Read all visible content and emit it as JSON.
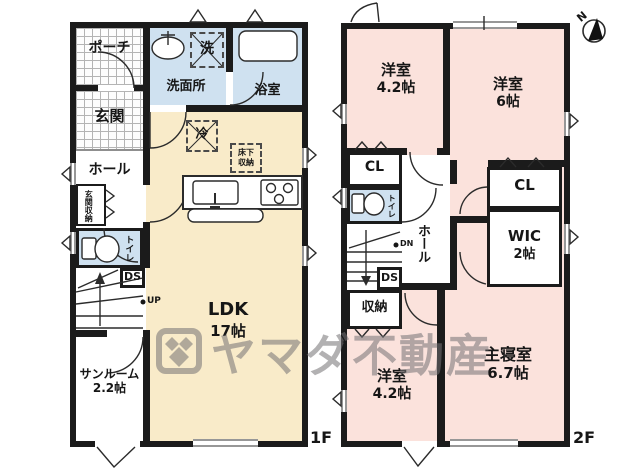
{
  "watermark": {
    "brand": "ヤマダ不動産"
  },
  "compass": {
    "north": "N"
  },
  "f1": {
    "floor_label": "1F",
    "porch": "ポーチ",
    "entrance": "玄関",
    "hall": "ホール",
    "entrance_storage": "玄関収納",
    "toilet": "トイレ",
    "ds": "DS",
    "up": "UP",
    "washroom": "洗面所",
    "washer": "洗",
    "bathroom": "浴室",
    "fridge": "冷",
    "underfloor_l1": "床下",
    "underfloor_l2": "収納",
    "ldk_name": "LDK",
    "ldk_size": "17帖",
    "sunroom_name": "サンルーム",
    "sunroom_size": "2.2帖"
  },
  "f2": {
    "floor_label": "2F",
    "room_nw_name": "洋室",
    "room_nw_size": "4.2帖",
    "room_ne_name": "洋室",
    "room_ne_size": "6帖",
    "cl_west": "CL",
    "toilet": "トイレ",
    "hall": "ホール",
    "dn": "DN",
    "ds": "DS",
    "storage": "収納",
    "cl_east": "CL",
    "wic_name": "WIC",
    "wic_size": "2帖",
    "master_name": "主寝室",
    "master_size": "6.7帖",
    "room_sw_name": "洋室",
    "room_sw_size": "4.2帖"
  }
}
